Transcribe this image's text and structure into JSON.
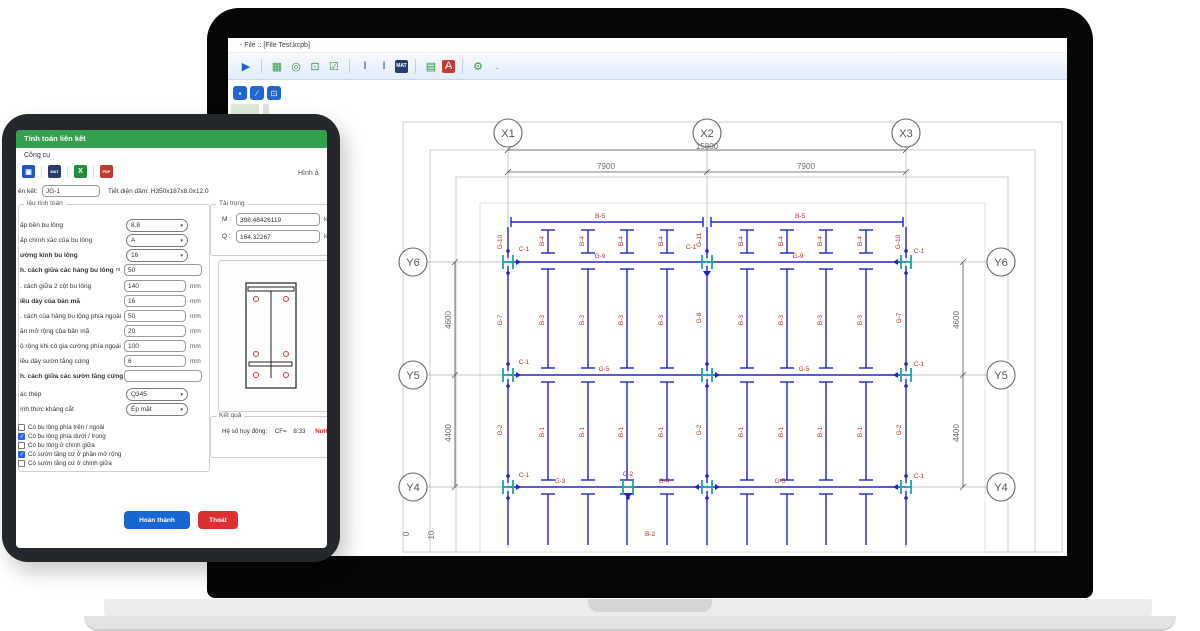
{
  "colors": {
    "accent_blue": "#1e66d0",
    "drawing_blue": "#2023c8",
    "drawing_teal": "#16a8a6",
    "label_red": "#b2342a",
    "header_green": "#33a04d",
    "status_red": "#e02222"
  },
  "laptop": {
    "titlebar": {
      "title": "- File :: [File Test.kcpb]"
    },
    "toolbar": {
      "icons": [
        {
          "name": "run-icon",
          "glyph": "▶",
          "fg": "#1565d8"
        },
        {
          "sep": true
        },
        {
          "name": "grid-icon",
          "glyph": "▦",
          "fg": "#2e9e45"
        },
        {
          "name": "capture-icon",
          "glyph": "◎",
          "fg": "#2e9e45"
        },
        {
          "name": "scan-icon",
          "glyph": "⊡",
          "fg": "#2e9e45"
        },
        {
          "name": "checklist-icon",
          "glyph": "☑",
          "fg": "#2e9e45"
        },
        {
          "sep": true
        },
        {
          "name": "column-section-icon",
          "glyph": "I",
          "fg": "#2c4575"
        },
        {
          "name": "beam-section-icon",
          "glyph": "I",
          "fg": "#2c4575"
        },
        {
          "name": "mat-export-icon",
          "glyph": "MAT",
          "fg": "#ffffff",
          "bg": "#253c6e",
          "small": true
        },
        {
          "sep": true
        },
        {
          "name": "excel-icon",
          "glyph": "▤",
          "fg": "#1e8e3e"
        },
        {
          "name": "pdf-icon",
          "glyph": "A",
          "fg": "#ffffff",
          "bg": "#c23b2e"
        },
        {
          "sep": true
        },
        {
          "name": "settings-icon",
          "glyph": "⚙",
          "fg": "#2e9e45"
        },
        {
          "name": "more-dot",
          "glyph": ".",
          "fg": "#777777"
        }
      ]
    },
    "quick_buttons": [
      {
        "name": "quick-select-button",
        "glyph": "▪"
      },
      {
        "name": "quick-edit-button",
        "glyph": "∕"
      },
      {
        "name": "quick-export-button",
        "glyph": "⊡"
      }
    ]
  },
  "drawing": {
    "beam_bands": [
      {
        "label": "B-4",
        "y": 241
      },
      {
        "label": "B-3",
        "y": 320
      },
      {
        "label": "B-1",
        "y": 432
      }
    ],
    "labels": [
      {
        "t": "X1",
        "x": 508,
        "y": 137,
        "cls": "grid"
      },
      {
        "t": "X2",
        "x": 707,
        "y": 137,
        "cls": "grid"
      },
      {
        "t": "X3",
        "x": 906,
        "y": 137,
        "cls": "grid"
      },
      {
        "t": "Y6",
        "x": 413,
        "y": 266,
        "cls": "grid"
      },
      {
        "t": "Y5",
        "x": 413,
        "y": 379,
        "cls": "grid"
      },
      {
        "t": "Y4",
        "x": 413,
        "y": 491,
        "cls": "grid"
      },
      {
        "t": "Y6",
        "x": 1001,
        "y": 266,
        "cls": "grid"
      },
      {
        "t": "Y5",
        "x": 1001,
        "y": 379,
        "cls": "grid"
      },
      {
        "t": "Y4",
        "x": 1001,
        "y": 491,
        "cls": "grid"
      },
      {
        "t": "15800",
        "x": 707,
        "y": 149,
        "cls": "dim"
      },
      {
        "t": "7900",
        "x": 606,
        "y": 169,
        "cls": "dim"
      },
      {
        "t": "7900",
        "x": 806,
        "y": 169,
        "cls": "dim"
      },
      {
        "t": "4600",
        "x": 451,
        "y": 320,
        "cls": "dim",
        "rot": 1
      },
      {
        "t": "4400",
        "x": 451,
        "y": 433,
        "cls": "dim",
        "rot": 1
      },
      {
        "t": "4600",
        "x": 959,
        "y": 320,
        "cls": "dim",
        "rot": 1
      },
      {
        "t": "4400",
        "x": 959,
        "y": 433,
        "cls": "dim",
        "rot": 1
      },
      {
        "t": "0",
        "x": 409,
        "y": 534,
        "cls": "dim",
        "rot": 1
      },
      {
        "t": "10",
        "x": 434,
        "y": 535,
        "cls": "dim",
        "rot": 1
      },
      {
        "t": "B-5",
        "x": 600,
        "y": 218
      },
      {
        "t": "B-5",
        "x": 800,
        "y": 218
      },
      {
        "t": "G-10",
        "x": 502,
        "y": 242,
        "rot": 1
      },
      {
        "t": "G-11",
        "x": 701,
        "y": 240,
        "rot": 1
      },
      {
        "t": "G-10",
        "x": 900,
        "y": 242,
        "rot": 1
      },
      {
        "t": "C-1",
        "x": 524,
        "y": 251
      },
      {
        "t": "C-1",
        "x": 691,
        "y": 249
      },
      {
        "t": "C-1",
        "x": 919,
        "y": 253
      },
      {
        "t": "G-9",
        "x": 600,
        "y": 258
      },
      {
        "t": "G-9",
        "x": 798,
        "y": 258
      },
      {
        "t": "G-7",
        "x": 502,
        "y": 320,
        "rot": 1
      },
      {
        "t": "G-8",
        "x": 701,
        "y": 318,
        "rot": 1
      },
      {
        "t": "G-7",
        "x": 901,
        "y": 318,
        "rot": 1
      },
      {
        "t": "C-1",
        "x": 524,
        "y": 364
      },
      {
        "t": "C-1",
        "x": 919,
        "y": 366
      },
      {
        "t": "G-5",
        "x": 604,
        "y": 371
      },
      {
        "t": "G-5",
        "x": 804,
        "y": 371
      },
      {
        "t": "G-2",
        "x": 502,
        "y": 430,
        "rot": 1
      },
      {
        "t": "G-2",
        "x": 701,
        "y": 430,
        "rot": 1
      },
      {
        "t": "G-2",
        "x": 901,
        "y": 430,
        "rot": 1
      },
      {
        "t": "C-1",
        "x": 524,
        "y": 477
      },
      {
        "t": "C-2",
        "x": 628,
        "y": 476
      },
      {
        "t": "C-1",
        "x": 919,
        "y": 478
      },
      {
        "t": "G-3",
        "x": 560,
        "y": 483
      },
      {
        "t": "G-4",
        "x": 664,
        "y": 483
      },
      {
        "t": "G-5",
        "x": 780,
        "y": 483
      },
      {
        "t": "B-2",
        "x": 650,
        "y": 536
      }
    ]
  },
  "tablet": {
    "dialog": {
      "title": "Tính toán liên kết",
      "menu": "Công cụ",
      "toolbar": {
        "icons": [
          {
            "name": "save-icon",
            "glyph": "▣",
            "bg": "#1f59c9"
          },
          {
            "name": "mat-export-icon",
            "glyph": "MAT",
            "bg": "#253c6e",
            "small": true
          },
          {
            "name": "excel-export-icon",
            "glyph": "X",
            "bg": "#1e8e3e"
          },
          {
            "name": "pdf-export-icon",
            "glyph": "PDF",
            "bg": "#c23b2e",
            "small": true
          }
        ],
        "right_label": "Hình ả"
      },
      "connection": {
        "label": "ên kết:",
        "value": "JG-1",
        "section": "Tiết diện dầm: H350x187x8.0x12.0"
      },
      "form": {
        "legend": "iệu tính toán",
        "rows": [
          {
            "label": "ấp bền bu lông",
            "type": "select",
            "value": "8.8"
          },
          {
            "label": "ấp chính xác của bu lông",
            "type": "select",
            "value": "A"
          },
          {
            "label": "ường kính bu lông",
            "bold": true,
            "type": "select",
            "value": "16"
          },
          {
            "label": "h. cách giữa các hàng bu lông",
            "bold": true,
            "prefix": "ni",
            "type": "input",
            "value": "50",
            "wide": true
          },
          {
            "label": ". cách giữa 2 cột bu lông",
            "type": "input",
            "value": "140",
            "unit": "mm"
          },
          {
            "label": "iều dày của bản mã",
            "bold": true,
            "type": "input",
            "value": "16",
            "unit": "mm"
          },
          {
            "label": ". cách của hàng bu lông phía ngoài",
            "type": "input",
            "value": "50",
            "unit": "mm"
          },
          {
            "label": "ần mở rộng của bản mã",
            "type": "input",
            "value": "20",
            "unit": "mm"
          },
          {
            "label": "ộ rộng khi có gia cường phía ngoài",
            "type": "input",
            "value": "100",
            "unit": "mm"
          },
          {
            "label": "iều dày sườn tăng cứng",
            "type": "input",
            "value": "6",
            "unit": "mm"
          },
          {
            "label": "h. cách giữa các sườn tăng cứng",
            "bold": true,
            "type": "input",
            "value": "",
            "wide": true
          },
          {
            "label": "ác thép",
            "type": "select",
            "value": "Q345"
          },
          {
            "label": "ình thức kháng cắt",
            "type": "select",
            "value": "Ép mặt"
          }
        ]
      },
      "checks": [
        {
          "label": "Có bu lông phía trên / ngoài",
          "checked": false
        },
        {
          "label": "Có bu lông phía dưới / trong",
          "checked": true
        },
        {
          "label": "Có bu lông ở chính giữa",
          "checked": false
        },
        {
          "label": "Có sườn tăng cứ ở phần mở rộng",
          "checked": true
        },
        {
          "label": "Có sườn tăng cứ ở chính giữa",
          "checked": false
        }
      ],
      "loads": {
        "legend": "Tải trọng",
        "rows": [
          {
            "label": "M :",
            "value": "398.48426119",
            "unit": "kN"
          },
          {
            "label": "Q :",
            "value": "164.32267",
            "unit": "kN"
          }
        ]
      },
      "result": {
        "legend": "Kết quả",
        "text": "Hệ số huy động:",
        "cf": "CF=",
        "value": "8.33",
        "status": "NotOK"
      },
      "buttons": {
        "ok": "Hoàn thành",
        "cancel": "Thoát"
      }
    }
  }
}
